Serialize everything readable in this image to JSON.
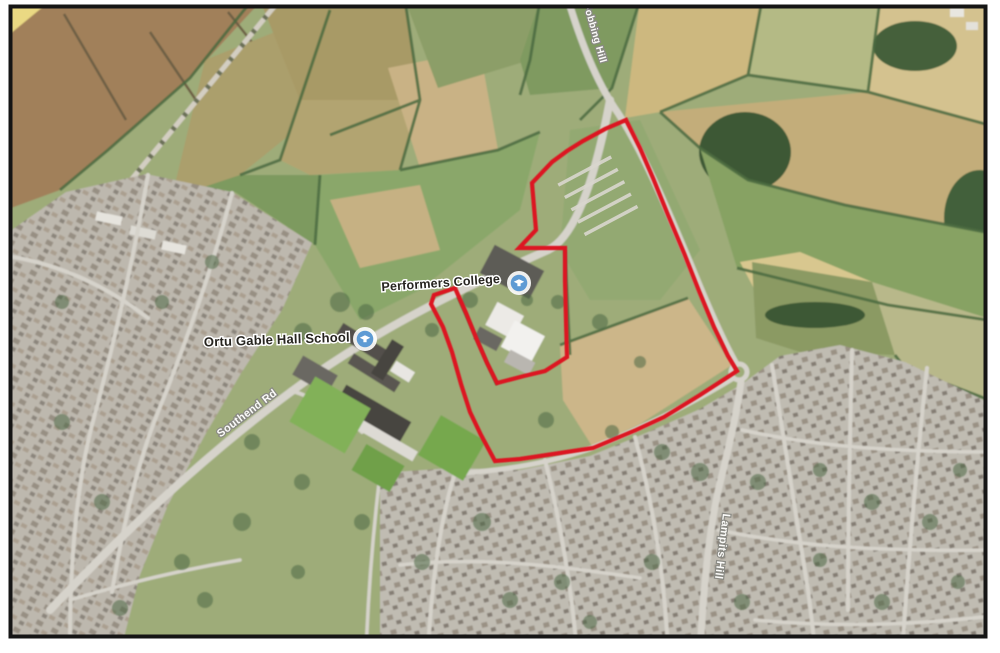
{
  "figure": {
    "type": "aerial-satellite-map",
    "description": "Aerial photograph with red site boundary around land at Performers College / east of Ortu Gable Hall School, Corringham",
    "frame_color": "#151515",
    "margin_color": "#ffffff"
  },
  "map": {
    "poi_labels": [
      {
        "id": "performers-college-label",
        "text": "Performers College",
        "x": 441,
        "y": 287,
        "rotation": -4,
        "size": 12.5
      },
      {
        "id": "gable-hall-school-label",
        "text": "Ortu Gable Hall School",
        "x": 277,
        "y": 344,
        "rotation": -2,
        "size": 13
      }
    ],
    "road_labels": [
      {
        "id": "southend-rd-label",
        "text": "Southend Rd",
        "x": 249,
        "y": 416,
        "rotation": -37,
        "size": 11
      },
      {
        "id": "fobbing-hill-label",
        "text": "Fobbing Hill",
        "x": 592,
        "y": 34,
        "rotation": 74,
        "size": 10
      },
      {
        "id": "lampits-hill-label",
        "text": "Lampits Hill",
        "x": 719,
        "y": 546,
        "rotation": 97,
        "size": 11
      }
    ],
    "markers": [
      {
        "id": "performers-college-marker",
        "x": 519,
        "y": 283
      },
      {
        "id": "gable-hall-school-marker",
        "x": 365,
        "y": 339
      }
    ],
    "site_boundary": {
      "color": "#dc1720",
      "stroke_width": 4.2,
      "points": [
        [
          626,
          120
        ],
        [
          640,
          148
        ],
        [
          653,
          178
        ],
        [
          668,
          215
        ],
        [
          684,
          253
        ],
        [
          699,
          291
        ],
        [
          714,
          327
        ],
        [
          728,
          356
        ],
        [
          737,
          371
        ],
        [
          700,
          395
        ],
        [
          664,
          417
        ],
        [
          636,
          430
        ],
        [
          593,
          448
        ],
        [
          560,
          453
        ],
        [
          520,
          459
        ],
        [
          495,
          461
        ],
        [
          481,
          435
        ],
        [
          470,
          412
        ],
        [
          461,
          384
        ],
        [
          452,
          352
        ],
        [
          443,
          327
        ],
        [
          431,
          304
        ],
        [
          434,
          295
        ],
        [
          455,
          288
        ],
        [
          466,
          313
        ],
        [
          477,
          340
        ],
        [
          487,
          363
        ],
        [
          497,
          383
        ],
        [
          524,
          376
        ],
        [
          545,
          371
        ],
        [
          567,
          357
        ],
        [
          566,
          320
        ],
        [
          565,
          280
        ],
        [
          565,
          248
        ],
        [
          540,
          248
        ],
        [
          519,
          248
        ],
        [
          536,
          230
        ],
        [
          534,
          207
        ],
        [
          532,
          183
        ],
        [
          552,
          162
        ],
        [
          567,
          151
        ],
        [
          583,
          141
        ],
        [
          605,
          129
        ]
      ]
    },
    "marker_style": {
      "halo": "#ffffff",
      "disc": "#5e9bd4",
      "glyph": "#ffffff"
    },
    "palette": {
      "field_green": "#9eac79",
      "field_tan": "#ccb689",
      "ploughed_brown": "#a1805a",
      "woodland": "#42603a",
      "housing_base": "#bdb8ae",
      "road": "#d6d3cb"
    },
    "trees": [
      [
        340,
        302,
        10
      ],
      [
        366,
        312,
        8
      ],
      [
        303,
        332,
        9
      ],
      [
        432,
        330,
        7
      ],
      [
        470,
        300,
        8
      ],
      [
        527,
        300,
        6
      ],
      [
        558,
        302,
        7
      ],
      [
        600,
        322,
        8
      ],
      [
        546,
        420,
        8
      ],
      [
        612,
        432,
        7
      ],
      [
        662,
        452,
        8
      ],
      [
        700,
        472,
        9
      ],
      [
        758,
        482,
        8
      ],
      [
        820,
        470,
        7
      ],
      [
        872,
        502,
        8
      ],
      [
        930,
        522,
        8
      ],
      [
        482,
        522,
        9
      ],
      [
        422,
        562,
        8
      ],
      [
        362,
        522,
        8
      ],
      [
        302,
        482,
        8
      ],
      [
        242,
        522,
        9
      ],
      [
        182,
        562,
        8
      ],
      [
        102,
        502,
        8
      ],
      [
        62,
        422,
        8
      ],
      [
        162,
        302,
        7
      ],
      [
        212,
        262,
        7
      ],
      [
        652,
        562,
        8
      ],
      [
        742,
        602,
        8
      ],
      [
        562,
        582,
        8
      ],
      [
        882,
        602,
        8
      ],
      [
        958,
        582,
        7
      ],
      [
        62,
        302,
        7
      ],
      [
        252,
        442,
        8
      ],
      [
        640,
        362,
        6
      ],
      [
        120,
        608,
        8
      ],
      [
        205,
        600,
        8
      ],
      [
        298,
        572,
        7
      ],
      [
        510,
        600,
        8
      ],
      [
        590,
        622,
        7
      ],
      [
        820,
        560,
        7
      ],
      [
        960,
        470,
        7
      ]
    ],
    "greenhouse_rows": 5
  }
}
